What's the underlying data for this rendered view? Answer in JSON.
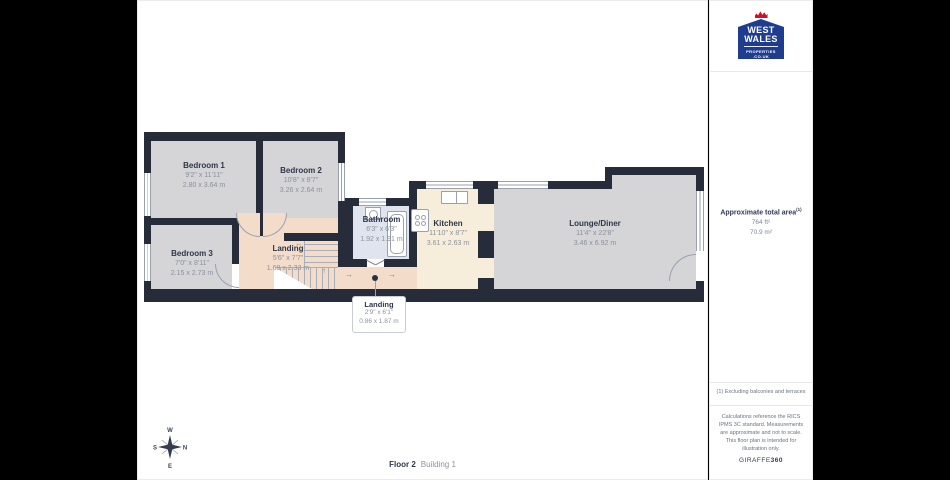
{
  "plan": {
    "rooms": [
      {
        "id": "bedroom1",
        "name": "Bedroom 1",
        "imperial": "9'2\" x 11'11\"",
        "metric": "2.80 x 3.64 m"
      },
      {
        "id": "bedroom2",
        "name": "Bedroom 2",
        "imperial": "10'8\" x 8'7\"",
        "metric": "3.26 x 2.64 m"
      },
      {
        "id": "bedroom3",
        "name": "Bedroom 3",
        "imperial": "7'0\" x 8'11\"",
        "metric": "2.15 x 2.73 m"
      },
      {
        "id": "landing",
        "name": "Landing",
        "imperial": "5'6\" x 7'7\"",
        "metric": "1.68 x 2.33 m"
      },
      {
        "id": "bathroom",
        "name": "Bathroom",
        "imperial": "6'3\" x 6'3\"",
        "metric": "1.92 x 1.91 m"
      },
      {
        "id": "kitchen",
        "name": "Kitchen",
        "imperial": "11'10\" x 8'7\"",
        "metric": "3.61 x 2.63 m"
      },
      {
        "id": "lounge",
        "name": "Lounge/Diner",
        "imperial": "11'4\" x 22'8\"",
        "metric": "3.46 x 6.92 m"
      }
    ],
    "callout": {
      "name": "Landing",
      "imperial": "2'9\" x 6'1\"",
      "metric": "0.86 x 1.87 m"
    },
    "arrows": {
      "left": "←",
      "up": "↑",
      "right": "→"
    }
  },
  "compass": {
    "n": "N",
    "e": "E",
    "s": "S",
    "w": "W"
  },
  "footer": {
    "floor_label": "Floor 2",
    "building_label": "Building 1"
  },
  "sidebar": {
    "area_title": "Approximate total area",
    "area_superscript": "(1)",
    "area_ft": "764 ft²",
    "area_m": "70.9 m²",
    "footnote": "(1) Excluding balconies and terraces",
    "disclaimer": "Calculations reference the RICS IPMS 3C standard. Measurements are approximate and not to scale. This floor plan is intended for illustration only.",
    "brand_name": "GIRAFFE",
    "brand_suffix": "360"
  },
  "logo": {
    "line1": "WEST",
    "line2": "WALES",
    "line3": "PROPERTIES",
    "line4": ".CO.UK"
  },
  "colors": {
    "wall": "#262c3a",
    "room_gray": "#d5d4d6",
    "room_peach": "#f3dcc9",
    "room_cream": "#f6eeda",
    "room_blue": "#dfe4ee",
    "logo_blue": "#1f3d8f",
    "logo_red": "#cf1125",
    "background": "#000000"
  }
}
